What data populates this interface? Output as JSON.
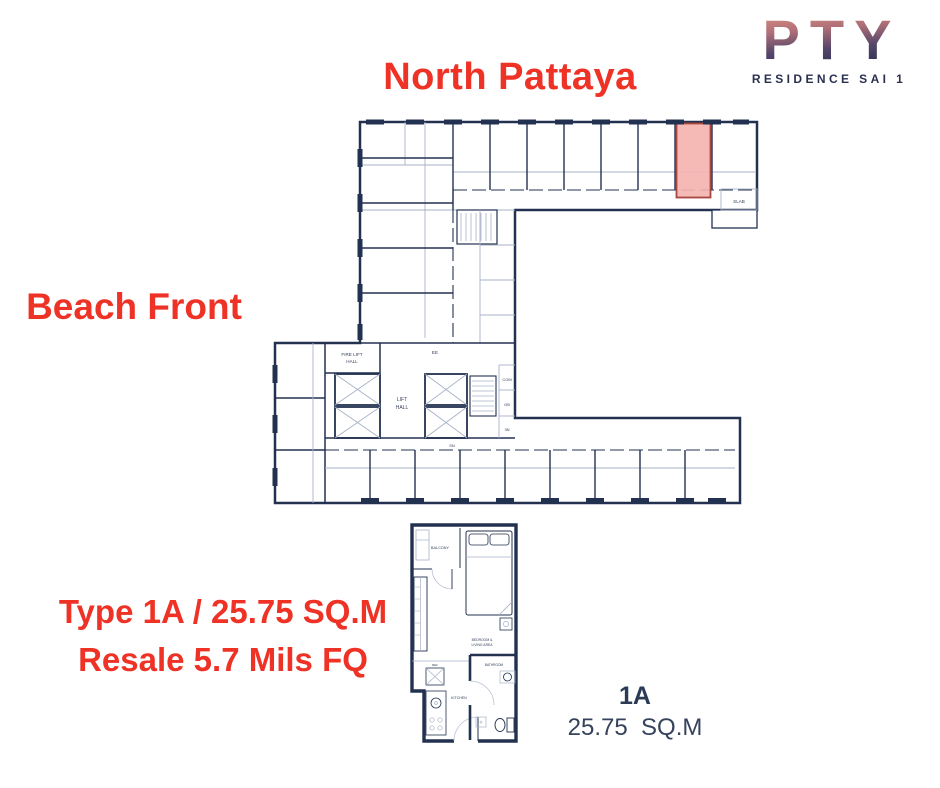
{
  "logo": {
    "brand": "PTY",
    "subtitle": "RESIDENCE SAI 1"
  },
  "labels": {
    "direction_top": "North Pattaya",
    "direction_left": "Beach Front",
    "offer_line1": "Type 1A / 25.75 SQ.M",
    "offer_line2": "Resale 5.7 Mils FQ",
    "unit_name": "1A",
    "unit_area": "25.75  SQ.M"
  },
  "floor_plan": {
    "fire_lift_line1": "FIRE LIFT",
    "fire_lift_line2": "HALL",
    "lift_line1": "LIFT",
    "lift_line2": "HALL",
    "ee": "EE",
    "com": "COM",
    "gb": "GB",
    "n3": "3N",
    "sn": "SN",
    "slab": "SLAB"
  },
  "unit_plan": {
    "balcony": "BALCONY",
    "bedroom_line1": "BEDROOM &",
    "bedroom_line2": "LIVING AREA",
    "ref": "REF",
    "kitchen": "KITCHEN",
    "bathroom": "BATHROOM"
  },
  "colors": {
    "accent_red": "#ee3226",
    "wall_navy": "#233150",
    "line_light": "#a7b2c7",
    "highlight_fill": "#f5b3ae",
    "highlight_stroke": "#a8463f",
    "logo_top": "#dd9184",
    "logo_bottom": "#232c4e"
  }
}
